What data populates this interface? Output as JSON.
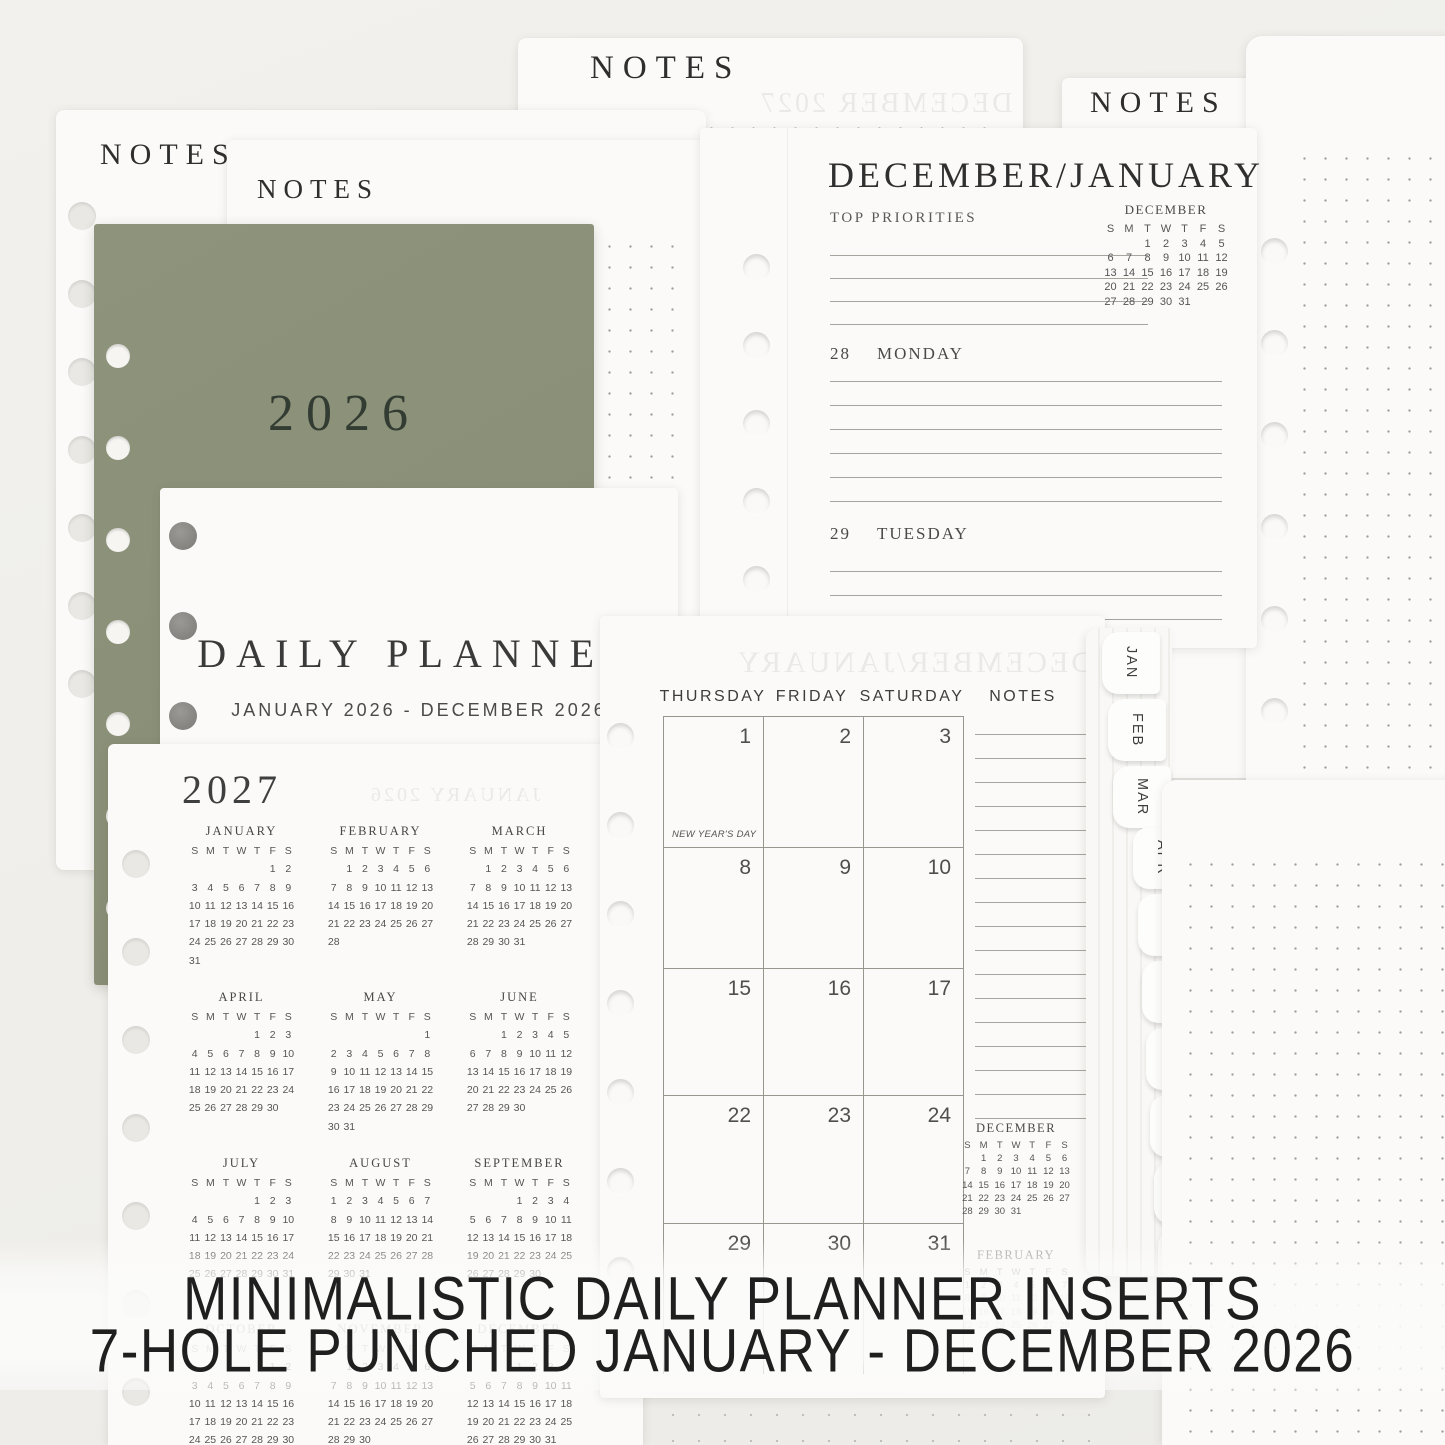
{
  "colors": {
    "background": "#f0efeb",
    "cover_green": "#8b9179",
    "text_dark": "#2f2f2f"
  },
  "banner": {
    "line1": "MINIMALISTIC DAILY PLANNER INSERTS",
    "line2": "7-HOLE PUNCHED JANUARY - DECEMBER 2026"
  },
  "notes": {
    "heading": "NOTES"
  },
  "cover": {
    "year": "2026"
  },
  "title_page": {
    "title": "DAILY PLANNER",
    "subtitle": "JANUARY 2026 - DECEMBER 2026"
  },
  "weekday_letters": [
    "S",
    "M",
    "T",
    "W",
    "T",
    "F",
    "S"
  ],
  "weekly_page": {
    "title": "DECEMBER/JANUARY",
    "priorities_label": "TOP PRIORITIES",
    "priorities_lines": 4,
    "mini_month": {
      "name": "DECEMBER",
      "start": 2,
      "days": 31
    },
    "days": [
      {
        "num": "28",
        "name": "MONDAY",
        "lines": 6
      },
      {
        "num": "29",
        "name": "TUESDAY",
        "lines": 3
      }
    ]
  },
  "year_page": {
    "year": "2027",
    "showthrough": "JANUARY 2026",
    "months": [
      {
        "name": "JANUARY",
        "start": 5,
        "days": 31
      },
      {
        "name": "FEBRUARY",
        "start": 1,
        "days": 28
      },
      {
        "name": "MARCH",
        "start": 1,
        "days": 31
      },
      {
        "name": "APRIL",
        "start": 4,
        "days": 30
      },
      {
        "name": "MAY",
        "start": 6,
        "days": 31
      },
      {
        "name": "JUNE",
        "start": 2,
        "days": 30
      },
      {
        "name": "JULY",
        "start": 4,
        "days": 31
      },
      {
        "name": "AUGUST",
        "start": 0,
        "days": 31
      },
      {
        "name": "SEPTEMBER",
        "start": 3,
        "days": 30
      },
      {
        "name": "OCTOBER",
        "start": 5,
        "days": 31
      },
      {
        "name": "NOVEMBER",
        "start": 1,
        "days": 30
      },
      {
        "name": "DECEMBER",
        "start": 3,
        "days": 31
      }
    ]
  },
  "monthly_page": {
    "showthrough": "DECEMBER/JANUARY",
    "day_headers": [
      "THURSDAY",
      "FRIDAY",
      "SATURDAY"
    ],
    "notes_label": "NOTES",
    "notes_lines": 17,
    "weeks": [
      [
        "1",
        "2",
        "3"
      ],
      [
        "8",
        "9",
        "10"
      ],
      [
        "15",
        "16",
        "17"
      ],
      [
        "22",
        "23",
        "24"
      ],
      [
        "29",
        "30",
        "31"
      ]
    ],
    "holiday": {
      "week": 0,
      "day": 0,
      "label": "NEW YEAR'S DAY"
    },
    "mini_months": [
      {
        "name": "DECEMBER",
        "start": 1,
        "days": 31
      },
      {
        "name": "FEBRUARY",
        "start": 0,
        "days": 28
      }
    ]
  },
  "notes_top": {
    "showthrough": "DECEMBER 2027"
  },
  "tabs": [
    "JAN",
    "FEB",
    "MAR",
    "APR",
    "MAY",
    "JUN",
    "JUL",
    "AUG",
    "SEP",
    "OCT"
  ]
}
